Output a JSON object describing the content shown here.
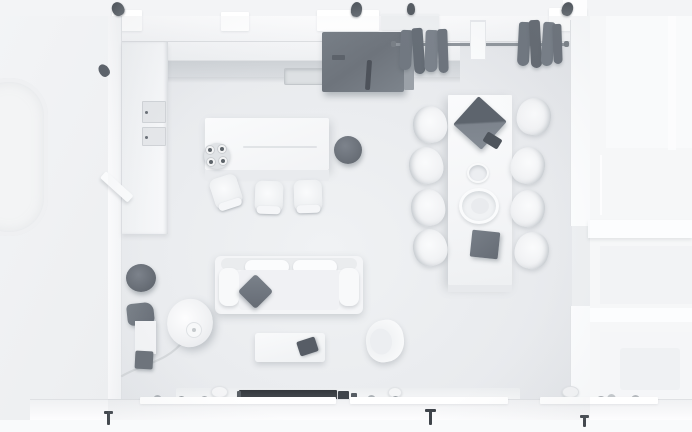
{
  "scene": {
    "type": "3d-floorplan-render",
    "view": "top-down",
    "room_label": "open-plan living room with kitchen, dining and lounge areas",
    "areas": [
      "kitchen",
      "dining-area",
      "living-area",
      "adjacent-rooms"
    ],
    "objects": [
      "kitchen counter with sink",
      "wall oven cabinet",
      "refrigerator",
      "kitchen island with 4-burner hob",
      "three bar chairs",
      "dark round stool",
      "clothes rail with hanging garments",
      "dining table for eight",
      "eight dining chairs",
      "open laptop",
      "phone",
      "bowl",
      "serving plate",
      "gray box on table",
      "three-seat sofa with throw pillow",
      "coffee table with tablet",
      "armchair",
      "floor lamp with cord",
      "planter pots by wall",
      "tv console with soundbar",
      "window sill plants",
      "door handles",
      "bathtub in adjacent room"
    ]
  },
  "palette": {
    "floor": "#e9ebee",
    "floor_light": "#f1f3f5",
    "wall": "#fcfdfe",
    "wall_shade": "#e0e2e5",
    "outside": "#f4f5f7",
    "counter": "#d2d5d9",
    "cabinet": "#f2f3f5",
    "white_f": "#f6f7f9",
    "shade": "#e6e8eb",
    "dark": "#70777f",
    "dark_deep": "#555b63",
    "tv": "#3b4046",
    "metal": "#8f959c",
    "cord": "#d5d8db"
  }
}
